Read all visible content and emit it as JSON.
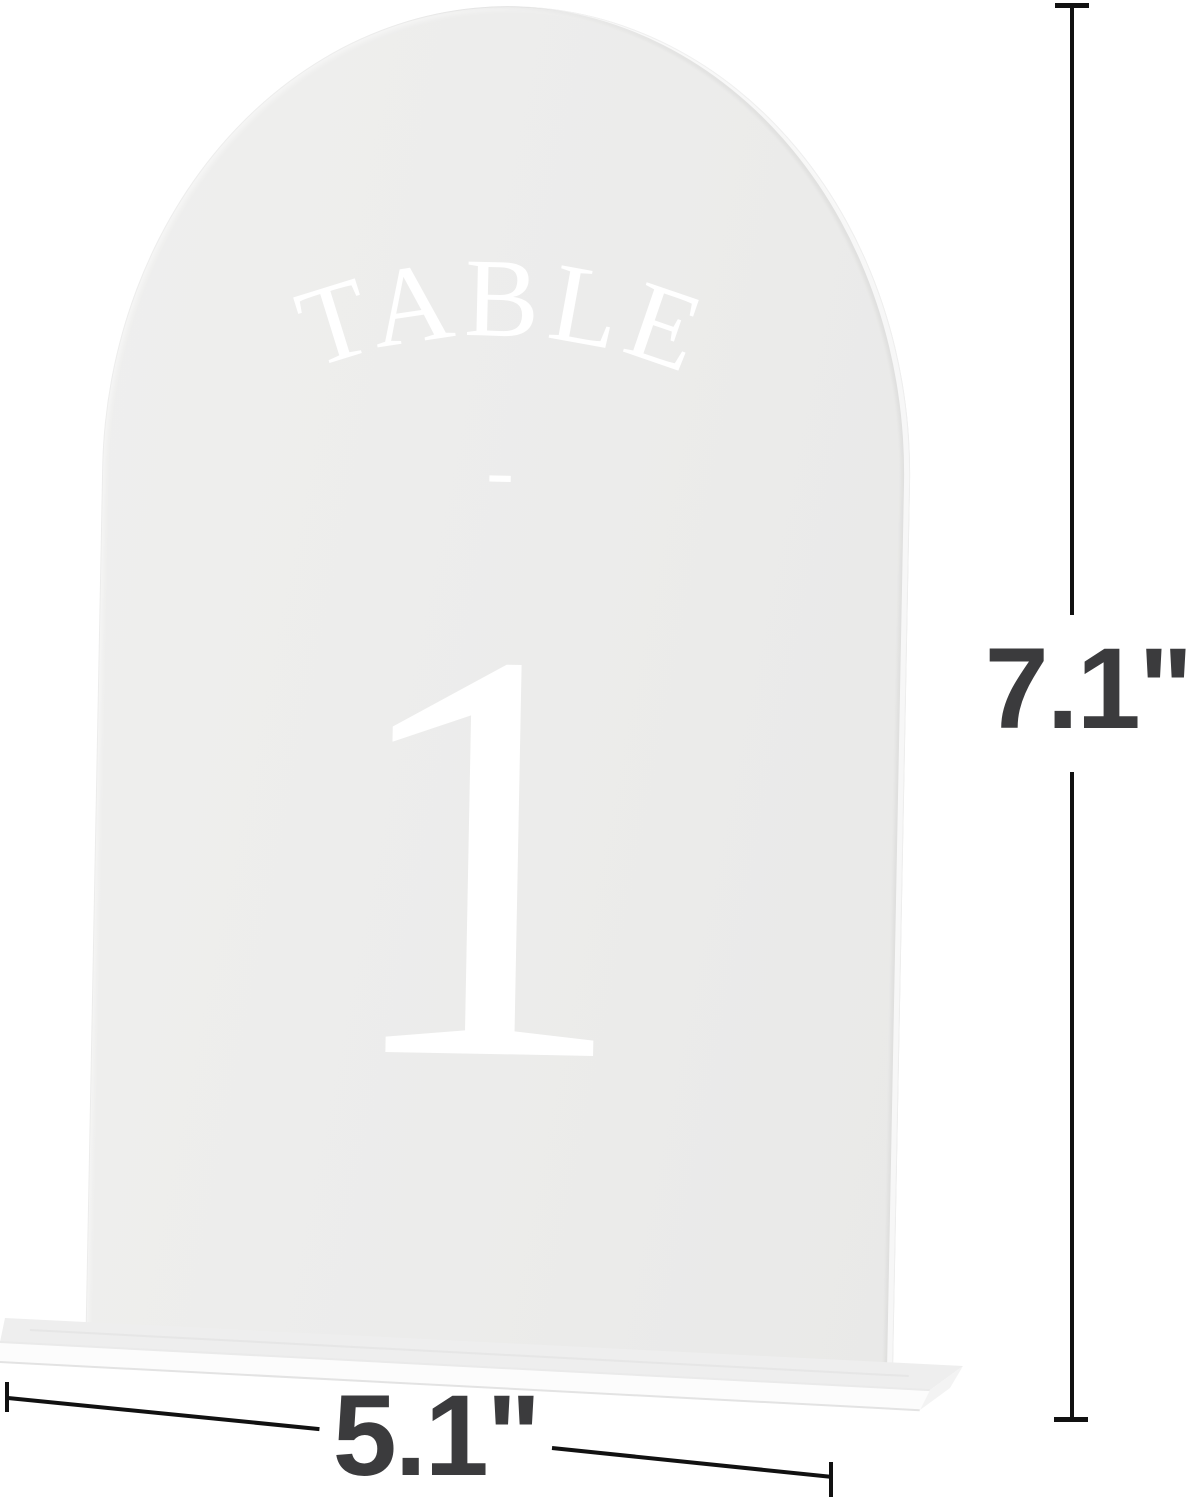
{
  "sign": {
    "arc_label": "TABLE",
    "divider": "-",
    "number": "1"
  },
  "dimensions": {
    "height_label": "7.1\"",
    "width_label": "5.1\""
  },
  "colors": {
    "background": "#ffffff",
    "panel_acrylic": "#ececeb",
    "panel_edge_highlight": "#f7f7f7",
    "base_top": "#f1f1f1",
    "base_front": "#fcfcfc",
    "sign_text": "#ffffff",
    "dimension_line": "#111111",
    "dimension_text": "#3b3b3d"
  }
}
